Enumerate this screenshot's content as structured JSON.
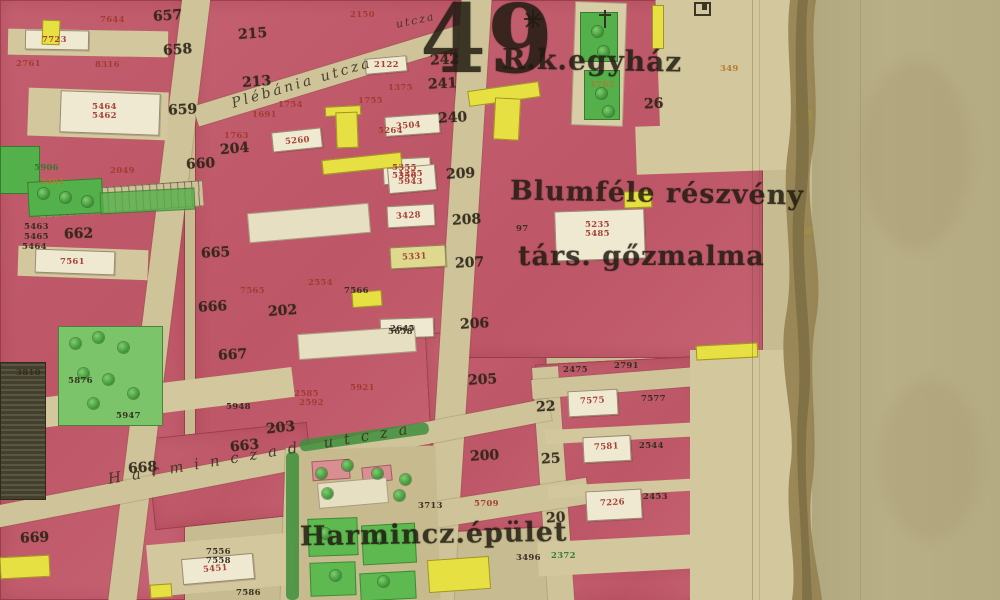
{
  "map": {
    "sheet_number": "49",
    "colors": {
      "paper": "#b6ac84",
      "street": "#cfc39a",
      "block_pink": "#c05c6b",
      "building_white": "#f0e9d1",
      "garden_green": "#54b04a",
      "highlight_yellow": "#e7e043",
      "ink": "#2a2316",
      "parcel_red": "#a33a30",
      "torn_edge_brown": "#93804f"
    },
    "title_labels": [
      {
        "t": "49",
        "x": 420,
        "y": -16,
        "s": 95,
        "r": 0
      },
      {
        "t": "R.k.egyház",
        "x": 502,
        "y": 44,
        "s": 28,
        "r": 1
      },
      {
        "t": "Blumféle részvény",
        "x": 510,
        "y": 178,
        "s": 27,
        "r": 1
      },
      {
        "t": "társ. gőzmalma",
        "x": 518,
        "y": 241,
        "s": 27,
        "r": 0
      },
      {
        "t": "Harmincz.épület",
        "x": 300,
        "y": 519,
        "s": 27,
        "r": -1
      }
    ],
    "street_labels": [
      {
        "t": "Plébánia utcza",
        "x": 232,
        "y": 96,
        "r": -16.5,
        "s": 14,
        "ls": 3
      },
      {
        "t": "Harminczad utcza",
        "x": 108,
        "y": 470,
        "r": -9.5,
        "s": 15,
        "ls": 11
      },
      {
        "t": "utcza",
        "x": 396,
        "y": 18,
        "r": -12,
        "s": 11,
        "ls": 2
      }
    ],
    "block_numbers": [
      {
        "t": "657",
        "x": 153,
        "y": 8,
        "r": -4
      },
      {
        "t": "658",
        "x": 163,
        "y": 42,
        "r": -4
      },
      {
        "t": "659",
        "x": 168,
        "y": 102,
        "r": -3
      },
      {
        "t": "660",
        "x": 186,
        "y": 156,
        "r": -3
      },
      {
        "t": "662",
        "x": 64,
        "y": 226,
        "r": -2
      },
      {
        "t": "665",
        "x": 201,
        "y": 245,
        "r": -3
      },
      {
        "t": "666",
        "x": 198,
        "y": 299,
        "r": -3
      },
      {
        "t": "667",
        "x": 218,
        "y": 347,
        "r": -3
      },
      {
        "t": "668",
        "x": 128,
        "y": 460,
        "r": -4
      },
      {
        "t": "669",
        "x": 20,
        "y": 530,
        "r": -3
      },
      {
        "t": "663",
        "x": 230,
        "y": 438,
        "r": -6
      },
      {
        "t": "203",
        "x": 266,
        "y": 420,
        "r": -6
      },
      {
        "t": "204",
        "x": 220,
        "y": 141,
        "r": -5
      },
      {
        "t": "202",
        "x": 268,
        "y": 303,
        "r": -4
      },
      {
        "t": "215",
        "x": 238,
        "y": 26,
        "r": -4
      },
      {
        "t": "213",
        "x": 242,
        "y": 74,
        "r": -4
      },
      {
        "t": "242",
        "x": 430,
        "y": 52,
        "r": -3
      },
      {
        "t": "241",
        "x": 428,
        "y": 76,
        "r": -3
      },
      {
        "t": "240",
        "x": 438,
        "y": 110,
        "r": -3
      },
      {
        "t": "209",
        "x": 446,
        "y": 166,
        "r": -3
      },
      {
        "t": "208",
        "x": 452,
        "y": 212,
        "r": -3
      },
      {
        "t": "207",
        "x": 455,
        "y": 255,
        "r": -3
      },
      {
        "t": "206",
        "x": 460,
        "y": 316,
        "r": -3
      },
      {
        "t": "205",
        "x": 468,
        "y": 372,
        "r": -3
      },
      {
        "t": "200",
        "x": 470,
        "y": 448,
        "r": -3
      },
      {
        "t": "22",
        "x": 536,
        "y": 399,
        "r": -3
      },
      {
        "t": "25",
        "x": 541,
        "y": 451,
        "r": -3
      },
      {
        "t": "20",
        "x": 546,
        "y": 510,
        "r": -3
      },
      {
        "t": "26",
        "x": 644,
        "y": 96,
        "r": -2
      }
    ],
    "parcel_numbers": [
      {
        "t": "7644",
        "x": 100,
        "y": 15,
        "c": "red"
      },
      {
        "t": "7723",
        "x": 42,
        "y": 35,
        "c": "red"
      },
      {
        "t": "2761",
        "x": 16,
        "y": 59,
        "c": "red"
      },
      {
        "t": "8316",
        "x": 95,
        "y": 60,
        "c": "red"
      },
      {
        "t": "5464",
        "x": 92,
        "y": 102,
        "c": "red"
      },
      {
        "t": "5462",
        "x": 92,
        "y": 111,
        "c": "red"
      },
      {
        "t": "2049",
        "x": 110,
        "y": 166,
        "c": "red"
      },
      {
        "t": "5906",
        "x": 34,
        "y": 163,
        "c": "green"
      },
      {
        "t": "5461",
        "x": 40,
        "y": 177,
        "c": "ochre"
      },
      {
        "t": "7561",
        "x": 60,
        "y": 257,
        "c": "red"
      },
      {
        "t": "5463",
        "x": 24,
        "y": 222,
        "c": "black"
      },
      {
        "t": "5465",
        "x": 24,
        "y": 232,
        "c": "black"
      },
      {
        "t": "5464",
        "x": 22,
        "y": 242,
        "c": "black"
      },
      {
        "t": "3810",
        "x": 16,
        "y": 368,
        "c": "black"
      },
      {
        "t": "5876",
        "x": 68,
        "y": 376,
        "c": "black"
      },
      {
        "t": "5947",
        "x": 116,
        "y": 411,
        "c": "black"
      },
      {
        "t": "5948",
        "x": 226,
        "y": 402,
        "c": "black"
      },
      {
        "t": "7556",
        "x": 206,
        "y": 547,
        "c": "black"
      },
      {
        "t": "7558",
        "x": 206,
        "y": 556,
        "c": "black"
      },
      {
        "t": "5451",
        "x": 203,
        "y": 564,
        "c": "red",
        "r": -5
      },
      {
        "t": "7586",
        "x": 236,
        "y": 588,
        "c": "black"
      },
      {
        "t": "2150",
        "x": 350,
        "y": 10,
        "c": "red"
      },
      {
        "t": "2122",
        "x": 374,
        "y": 60,
        "c": "red"
      },
      {
        "t": "1375",
        "x": 388,
        "y": 83,
        "c": "red"
      },
      {
        "t": "1754",
        "x": 278,
        "y": 100,
        "c": "red"
      },
      {
        "t": "1755",
        "x": 358,
        "y": 96,
        "c": "red"
      },
      {
        "t": "1691",
        "x": 252,
        "y": 110,
        "c": "red"
      },
      {
        "t": "1763",
        "x": 224,
        "y": 131,
        "c": "red"
      },
      {
        "t": "5260",
        "x": 285,
        "y": 136,
        "c": "red",
        "r": -5
      },
      {
        "t": "5264",
        "x": 378,
        "y": 126,
        "c": "red"
      },
      {
        "t": "3504",
        "x": 396,
        "y": 121,
        "c": "red",
        "r": -4
      },
      {
        "t": "5355",
        "x": 392,
        "y": 163,
        "c": "red"
      },
      {
        "t": "5356",
        "x": 392,
        "y": 171,
        "c": "red"
      },
      {
        "t": "1255",
        "x": 398,
        "y": 169,
        "c": "red"
      },
      {
        "t": "5943",
        "x": 398,
        "y": 177,
        "c": "red"
      },
      {
        "t": "3428",
        "x": 396,
        "y": 211,
        "c": "red",
        "r": -3
      },
      {
        "t": "5331",
        "x": 402,
        "y": 252,
        "c": "red",
        "r": -3
      },
      {
        "t": "2645",
        "x": 390,
        "y": 324,
        "c": "black"
      },
      {
        "t": "2554",
        "x": 308,
        "y": 278,
        "c": "red"
      },
      {
        "t": "7565",
        "x": 240,
        "y": 286,
        "c": "red"
      },
      {
        "t": "7566",
        "x": 344,
        "y": 286,
        "c": "black"
      },
      {
        "t": "5658",
        "x": 388,
        "y": 327,
        "c": "black"
      },
      {
        "t": "5921",
        "x": 350,
        "y": 383,
        "c": "red"
      },
      {
        "t": "2585",
        "x": 294,
        "y": 389,
        "c": "red"
      },
      {
        "t": "2592",
        "x": 299,
        "y": 398,
        "c": "red"
      },
      {
        "t": "97",
        "x": 516,
        "y": 224,
        "c": "black"
      },
      {
        "t": "5235",
        "x": 585,
        "y": 220,
        "c": "red"
      },
      {
        "t": "5485",
        "x": 585,
        "y": 229,
        "c": "red"
      },
      {
        "t": "1762",
        "x": 590,
        "y": 80,
        "c": "ochre"
      },
      {
        "t": "349",
        "x": 720,
        "y": 64,
        "c": "ochre"
      },
      {
        "t": "2475",
        "x": 563,
        "y": 365,
        "c": "black"
      },
      {
        "t": "2791",
        "x": 614,
        "y": 361,
        "c": "black"
      },
      {
        "t": "7575",
        "x": 580,
        "y": 396,
        "c": "red",
        "r": -3
      },
      {
        "t": "7577",
        "x": 641,
        "y": 394,
        "c": "black"
      },
      {
        "t": "7581",
        "x": 594,
        "y": 442,
        "c": "red",
        "r": -3
      },
      {
        "t": "2544",
        "x": 639,
        "y": 441,
        "c": "black"
      },
      {
        "t": "7226",
        "x": 600,
        "y": 498,
        "c": "red",
        "r": -3
      },
      {
        "t": "2453",
        "x": 643,
        "y": 492,
        "c": "black"
      },
      {
        "t": "3496",
        "x": 516,
        "y": 553,
        "c": "black"
      },
      {
        "t": "2372",
        "x": 551,
        "y": 551,
        "c": "green"
      },
      {
        "t": "3713",
        "x": 418,
        "y": 501,
        "c": "black"
      },
      {
        "t": "5709",
        "x": 474,
        "y": 499,
        "c": "red"
      }
    ],
    "symbols": [
      {
        "name": "sheet-corner-mark",
        "x": 694,
        "y": 2
      },
      {
        "name": "church-cross",
        "x": 598,
        "y": 12
      },
      {
        "name": "ornate-cross",
        "x": 524,
        "y": 12
      }
    ]
  }
}
